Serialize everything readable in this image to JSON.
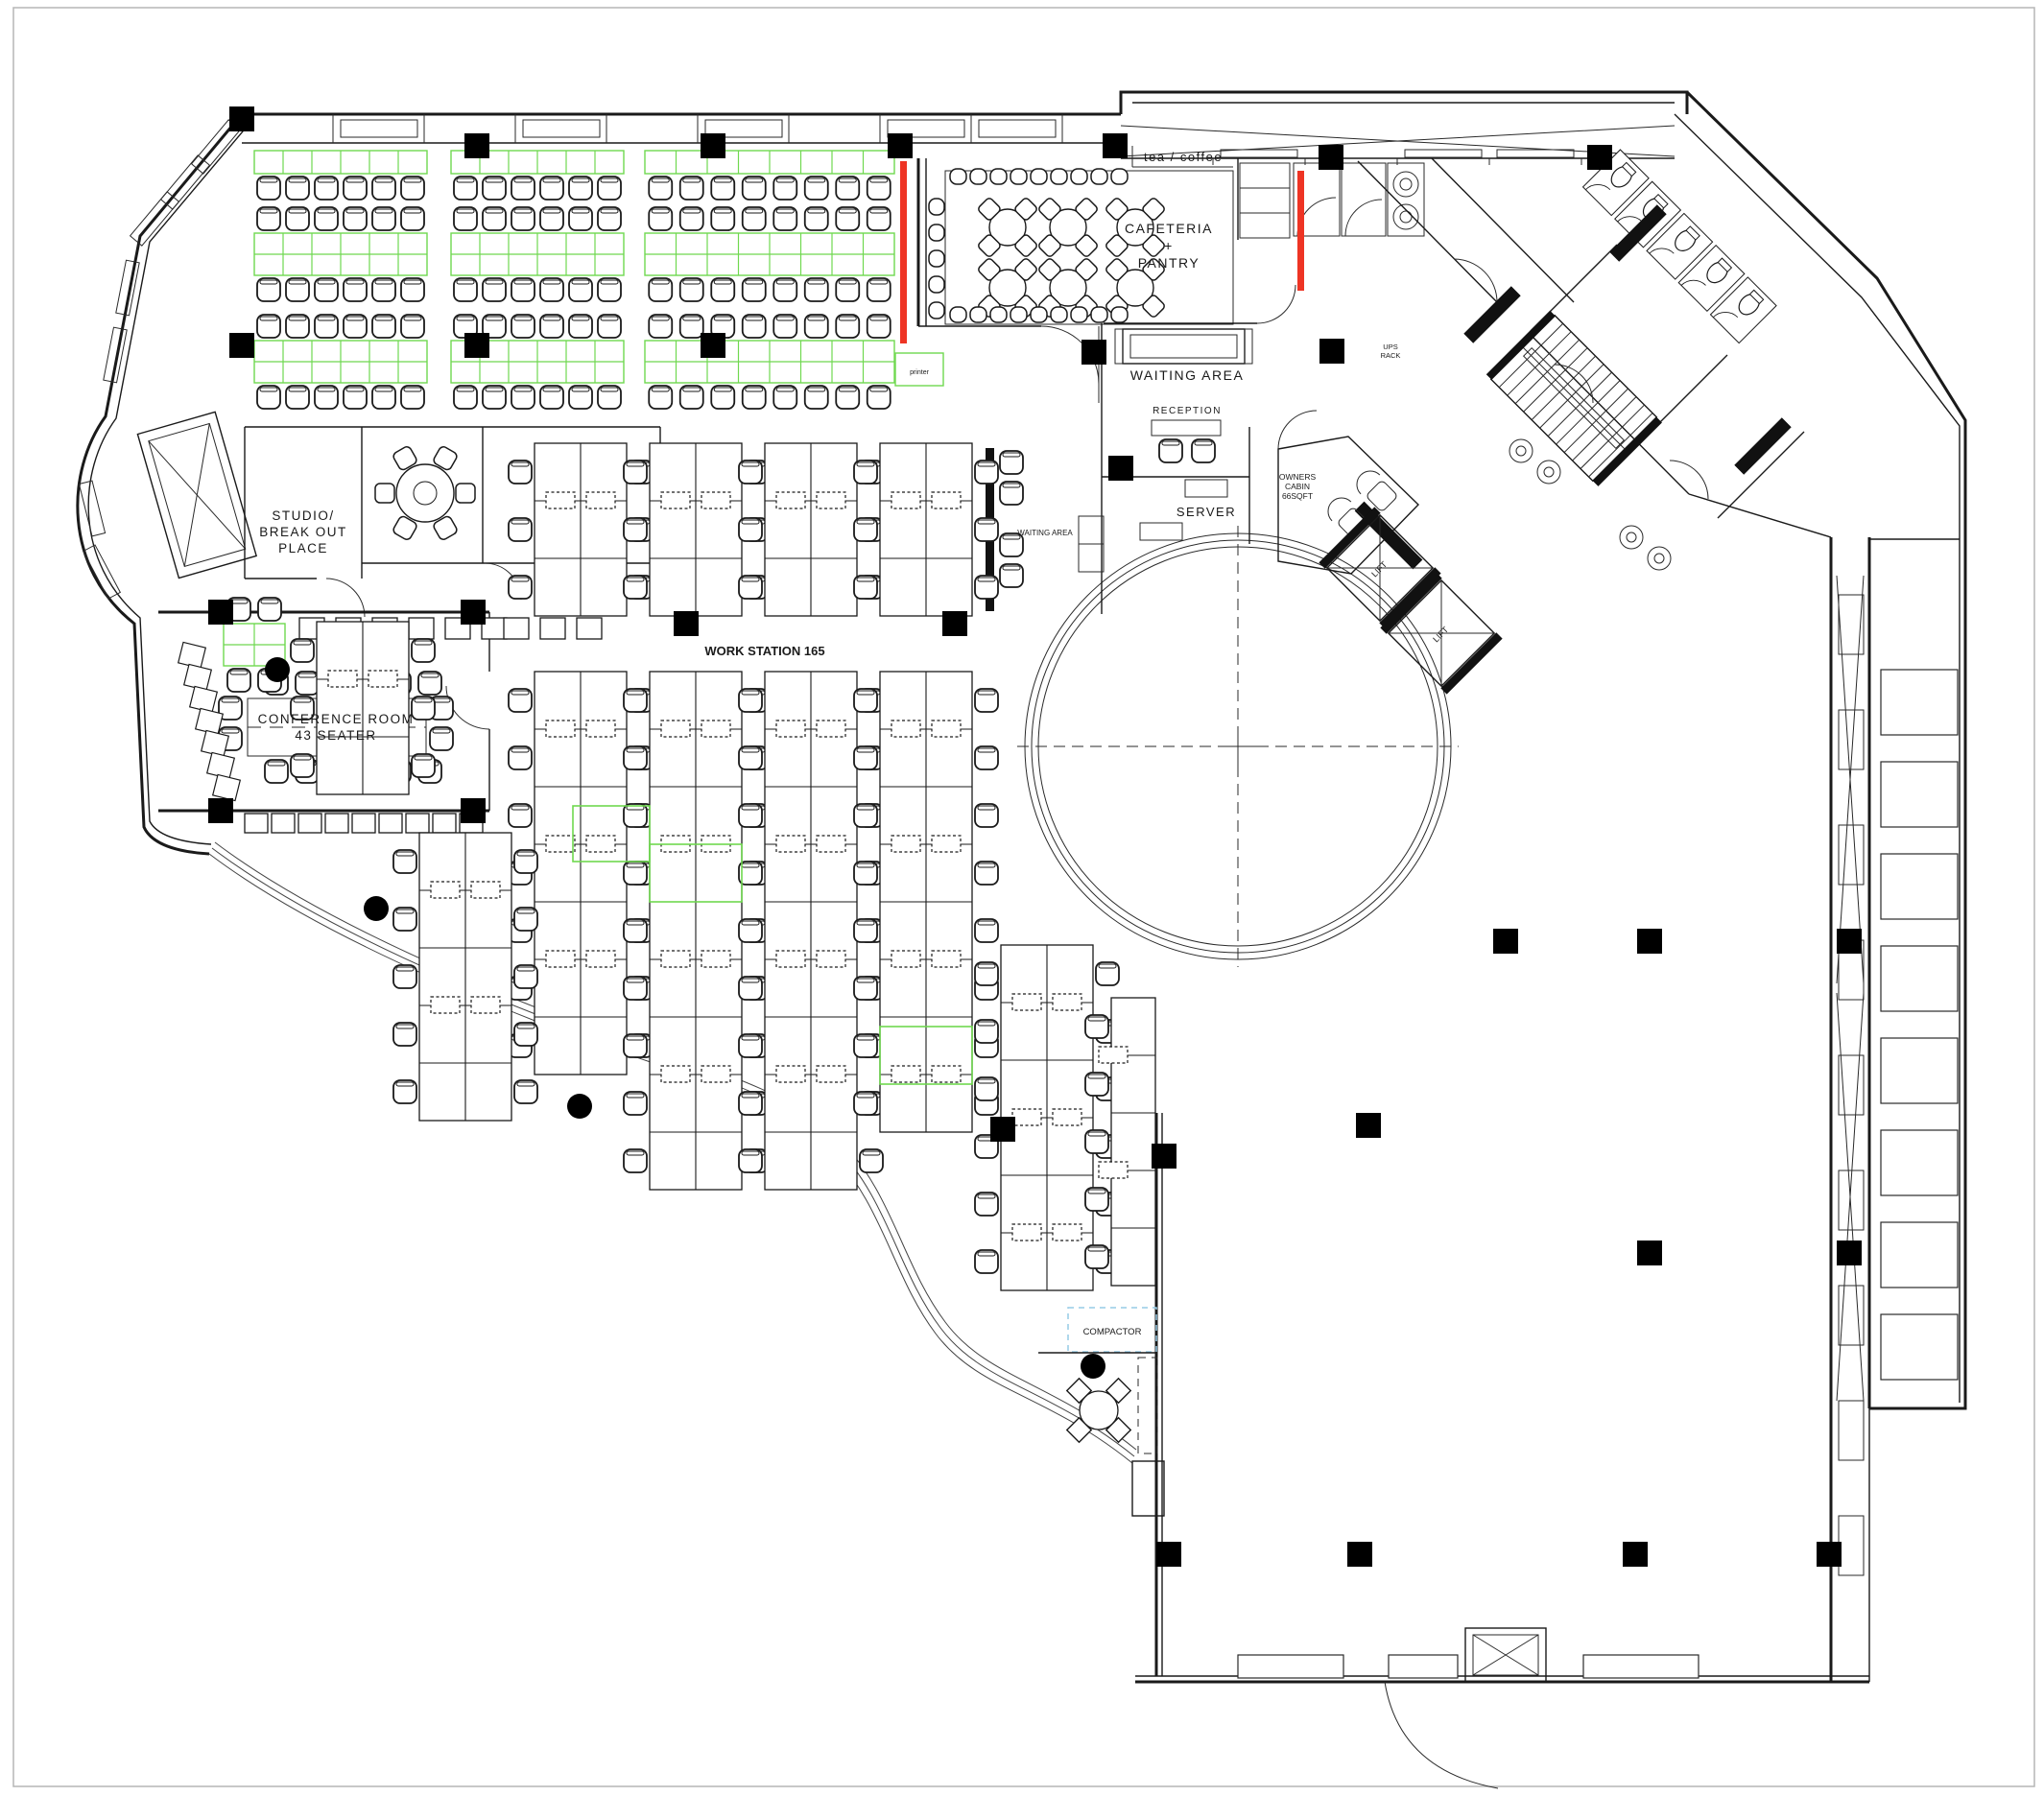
{
  "plan": {
    "type": "office-floor-plan",
    "labels": {
      "tea_coffee": "tea / coffee",
      "cafeteria": [
        "CAFETERIA",
        "+",
        "PANTRY"
      ],
      "waiting_area": "WAITING  AREA",
      "reception": "RECEPTION",
      "server": "SERVER",
      "owners_cabin": [
        "OWNERS",
        "CABIN",
        "66SQFT"
      ],
      "lift": "LIFT",
      "ups_rack": [
        "UPS",
        "RACK"
      ],
      "studio": [
        "STUDIO/",
        "BREAK  OUT",
        "PLACE"
      ],
      "conference": [
        "CONFERENCE  ROOM",
        "43  SEATER"
      ],
      "work_station": "WORK STATION 165",
      "waiting_area_small": "WAITING AREA",
      "compactor": "COMPACTOR",
      "printer": "printer"
    },
    "colors": {
      "wall": "#1a1a1a",
      "desk_green": "#6fd84f",
      "accent_red": "#ee3424",
      "compactor_blue": "#96cbe6",
      "background": "#ffffff"
    }
  }
}
